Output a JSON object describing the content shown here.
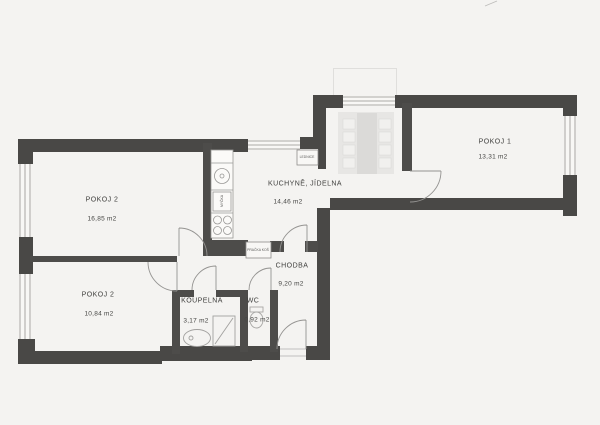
{
  "plan": {
    "rooms": {
      "pokoj1": {
        "name": "POKOJ 1",
        "area": "13,31 m2"
      },
      "pokoj2_top": {
        "name": "POKOJ 2",
        "area": "16,85 m2"
      },
      "pokoj2_bottom": {
        "name": "POKOJ 2",
        "area": "10,84 m2"
      },
      "kuchyne": {
        "name": "KUCHYNĚ, JÍDELNA",
        "area": "14,46 m2"
      },
      "chodba": {
        "name": "CHODBA",
        "area": "9,20 m2"
      },
      "koupelna": {
        "name": "KOUPELNA",
        "area": "3,17 m2"
      },
      "wc": {
        "name": "WC",
        "area": "0,92 m2"
      }
    },
    "fixtures": {
      "lednice_label": "LEDNICE",
      "mycka_label": "MYČKA",
      "pracka_label": "PRAČKA KOŠ"
    },
    "colors": {
      "background": "#f4f3f1",
      "wall": "#494846",
      "thin_line": "#8e8d8b",
      "text": "#3e3e3c"
    }
  }
}
